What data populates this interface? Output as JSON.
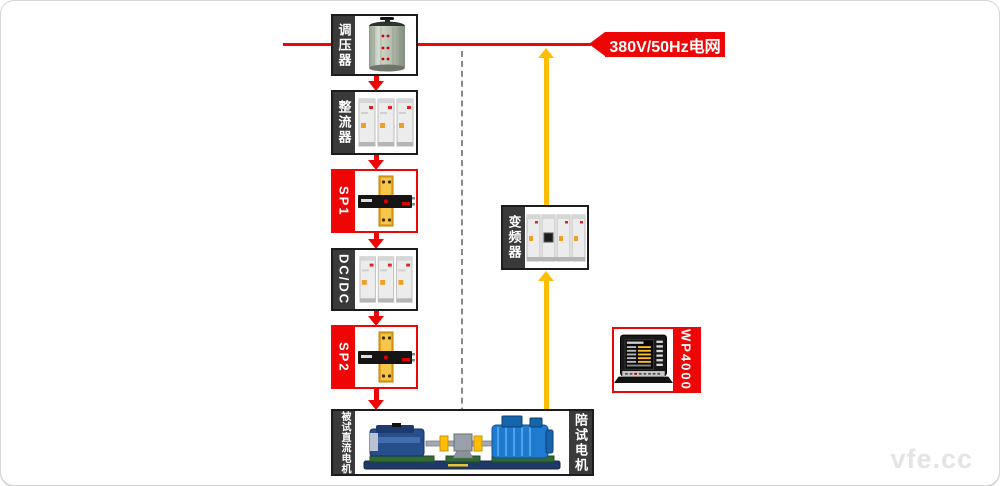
{
  "grid": {
    "label": "380V/50Hz电网"
  },
  "devices": {
    "regulator": {
      "label": "调压器"
    },
    "rectifier": {
      "label": "整流器"
    },
    "sp1": {
      "label": "SP1"
    },
    "dcdc": {
      "label": "DC/DC"
    },
    "sp2": {
      "label": "SP2"
    },
    "inverter": {
      "label": "变频器"
    },
    "analyzer": {
      "label": "WP4000"
    },
    "bench": {
      "tested_label": "被试直流电机",
      "drive_label": "陪试电机"
    }
  },
  "watermark": "vfe.cc",
  "colors": {
    "line_red": "#ee0505",
    "feedback_yellow": "#ffbe00",
    "sidebar_dark": "#3a3a3a",
    "dashed_gray": "#8a8a8a"
  }
}
